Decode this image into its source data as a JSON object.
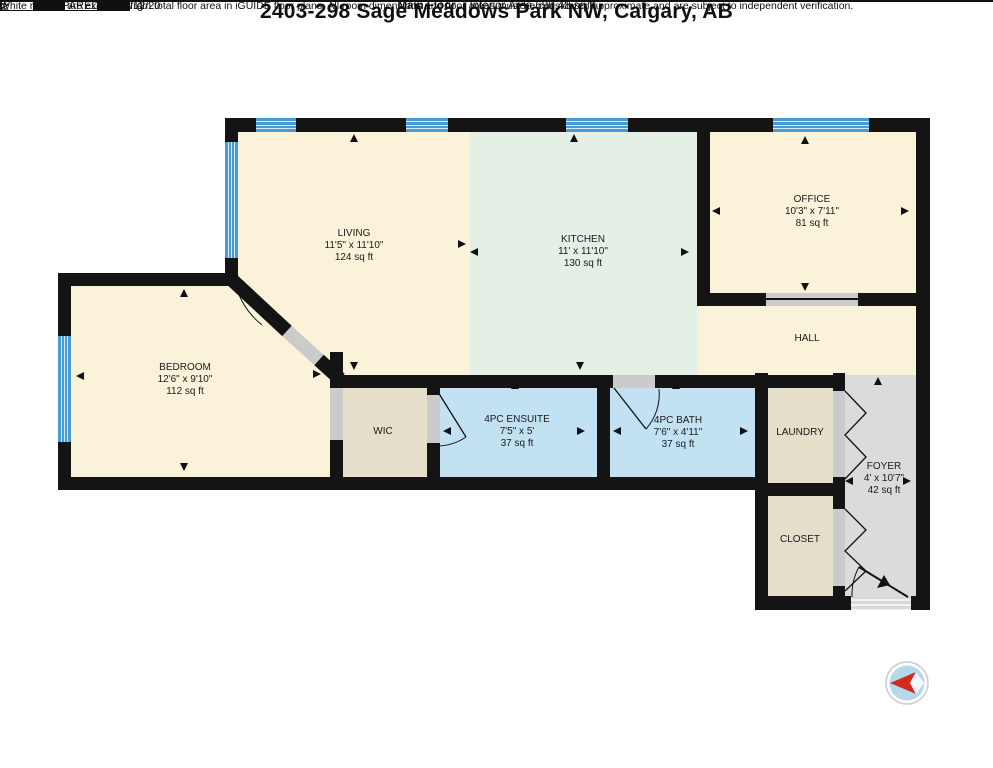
{
  "header": {
    "title": "2403-298 Sage Meadows Park NW, Calgary, AB",
    "floor_label": "Main Floor",
    "area_label": "Interior Area 690.48 sq ft"
  },
  "rooms": {
    "living": {
      "name": "LIVING",
      "dims": "11'5\" x 11'10\"",
      "area": "124 sq ft"
    },
    "kitchen": {
      "name": "KITCHEN",
      "dims": "11' x 11'10\"",
      "area": "130 sq ft"
    },
    "office": {
      "name": "OFFICE",
      "dims": "10'3\" x 7'11\"",
      "area": "81 sq ft"
    },
    "hall": {
      "name": "HALL"
    },
    "bedroom": {
      "name": "BEDROOM",
      "dims": "12'6\" x 9'10\"",
      "area": "112 sq ft"
    },
    "wic": {
      "name": "WIC"
    },
    "ensuite": {
      "name": "4PC ENSUITE",
      "dims": "7'5\" x 5'",
      "area": "37 sq ft"
    },
    "bath": {
      "name": "4PC BATH",
      "dims": "7'6\" x 4'11\"",
      "area": "37 sq ft"
    },
    "laundry": {
      "name": "LAUNDRY"
    },
    "foyer": {
      "name": "FOYER",
      "dims": "4' x 10'7\"",
      "area": "42 sq ft"
    },
    "closet": {
      "name": "CLOSET"
    }
  },
  "scale_bar": {
    "ticks": [
      "0",
      "3",
      "6"
    ],
    "unit": "ft"
  },
  "compass": {
    "label": "N"
  },
  "footer": {
    "prepared": "PREPARED: 2025/12/20",
    "disclaimer": "White regions are excluded from total floor area in iGUIDE floor plans. All room dimensions and floor areas must be considered approximate and are subject to independent verification."
  },
  "colors": {
    "wall": "#141414",
    "room_cream": "#FAF3D9",
    "room_green": "#E4EFE6",
    "room_blue": "#C2E2F4",
    "room_tan": "#E5DECA",
    "room_gray": "#DBDBDB",
    "window_blue": "#4A9BD0",
    "door_gray": "#CBCBCB",
    "compass_red": "#D42B1E"
  }
}
